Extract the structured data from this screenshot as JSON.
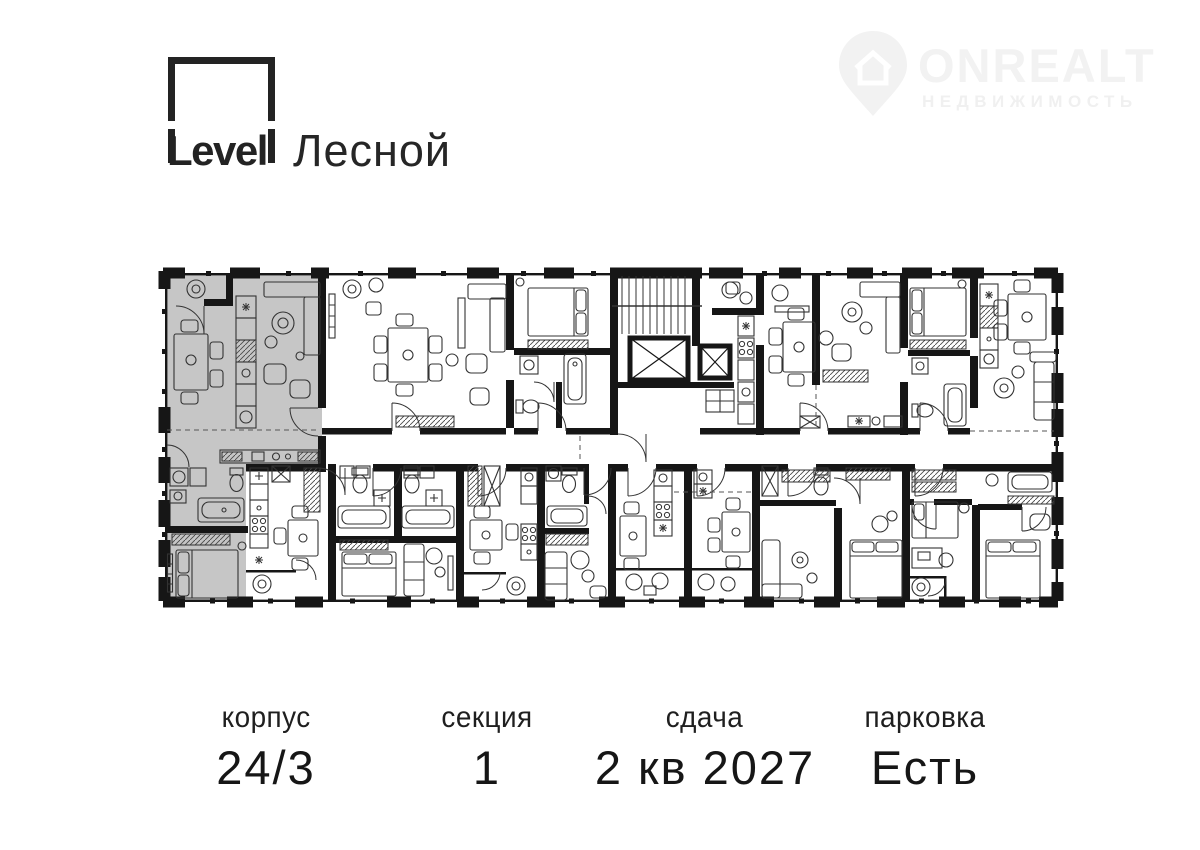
{
  "header": {
    "logo": {
      "brand": "Level",
      "project": "Лесной"
    },
    "watermark": {
      "name": "ONREALT",
      "tagline": "НЕДВИЖИМОСТЬ",
      "icon": "house-pin-icon"
    }
  },
  "floorplan": {
    "description": "Typical floor plan of section with one apartment highlighted in grey (top-left, L-shaped two-room unit with kitchen-living room, bedroom, bathroom); central stair core with two elevator shafts, common corridor, nine surrounding apartments with furniture symbols, balconies along outer walls"
  },
  "colors": {
    "wall": "#161616",
    "highlight": "#c6c6c6",
    "furniture": "#333333",
    "watermark": "#f2f2f2",
    "watermark2": "#f0f0f0"
  },
  "stats": [
    {
      "label": "корпус",
      "value": "24/3"
    },
    {
      "label": "секция",
      "value": "1"
    },
    {
      "label": "сдача",
      "value": "2 кв 2027"
    },
    {
      "label": "парковка",
      "value": "Есть"
    }
  ]
}
